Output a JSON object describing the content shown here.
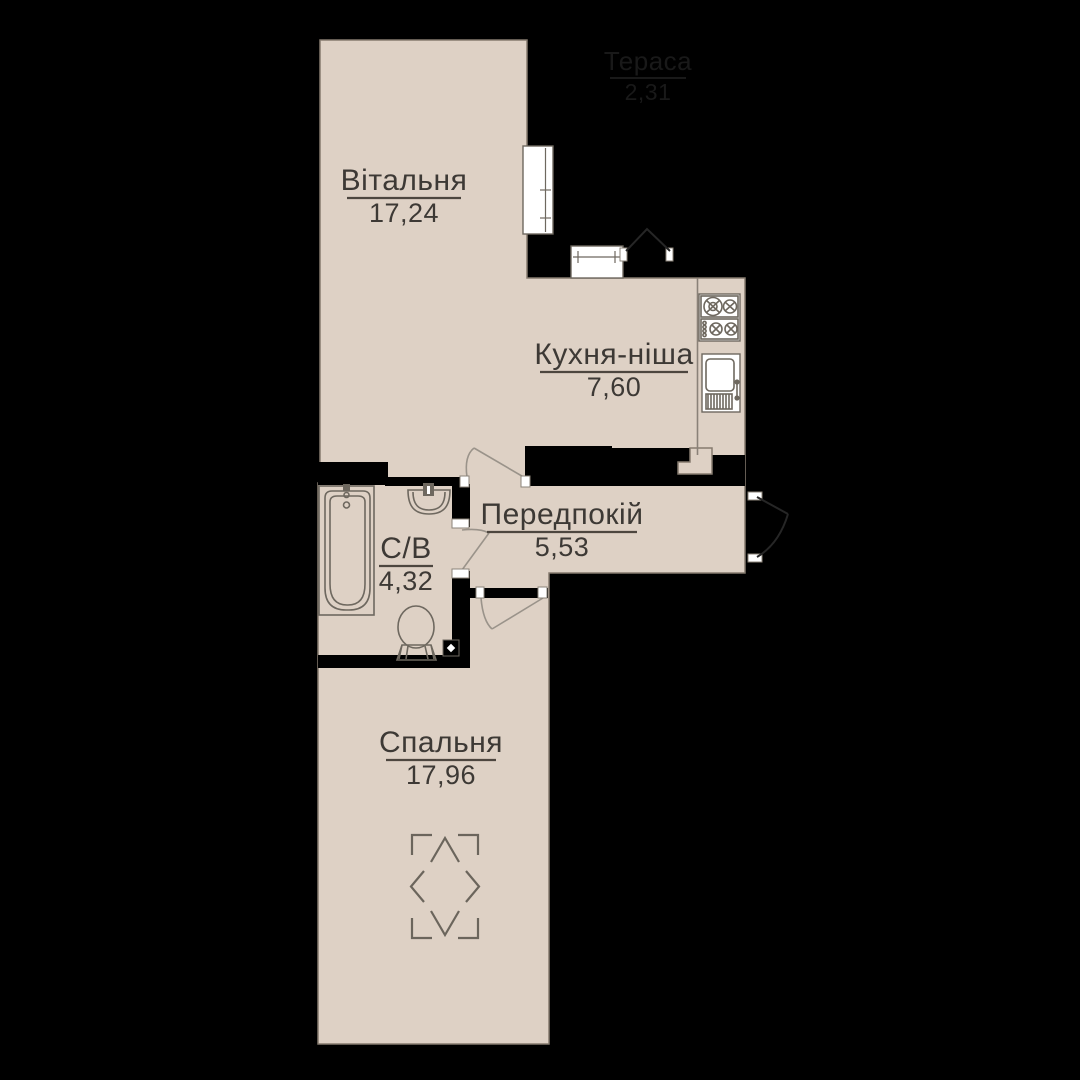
{
  "plan": {
    "type": "apartment-floor-plan",
    "language": "uk",
    "colors": {
      "background": "#000000",
      "floor": "#ded1c5",
      "walls": "#000000",
      "fixture_lines": "#6e685f",
      "label_text": "#3d3935",
      "terrace_label_text": "#191919",
      "window_fill": "#ffffff"
    },
    "rooms": [
      {
        "id": "living",
        "name": "Вітальня",
        "area": "17,24"
      },
      {
        "id": "kitchen",
        "name": "Кухня-ніша",
        "area": "7,60"
      },
      {
        "id": "hallway",
        "name": "Передпокій",
        "area": "5,53"
      },
      {
        "id": "bathroom",
        "name": "С/В",
        "area": "4,32"
      },
      {
        "id": "bedroom",
        "name": "Спальня",
        "area": "17,96"
      },
      {
        "id": "terrace",
        "name": "Тераса",
        "area": "2,31"
      }
    ],
    "fixtures": [
      "bathtub",
      "washbasin",
      "toilet",
      "vent-shaft",
      "gas-stove",
      "kitchen-sink",
      "bed-zone-marker"
    ],
    "openings": [
      "living-room-window",
      "kitchen-window",
      "terrace-door",
      "living-hall-door",
      "bathroom-door",
      "bedroom-door",
      "entrance-door"
    ]
  }
}
